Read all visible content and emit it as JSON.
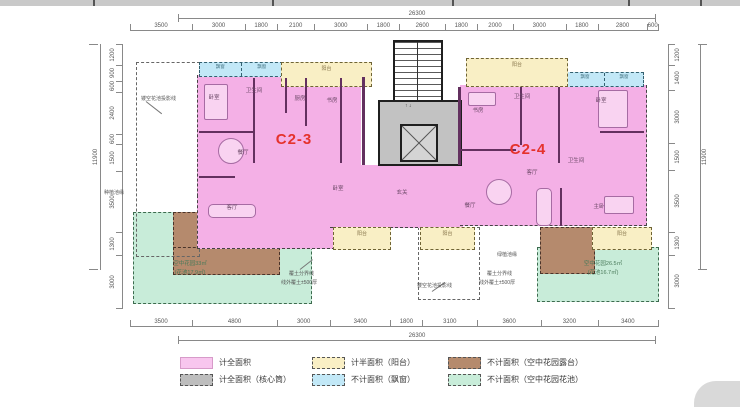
{
  "units": {
    "left": "C2-3",
    "right": "C2-4"
  },
  "dims": {
    "top_total": "26300",
    "top": [
      "3500",
      "3000",
      "1800",
      "2100",
      "3000",
      "1800",
      "2600",
      "1800",
      "2000",
      "3000",
      "1800",
      "2800",
      "600"
    ],
    "bottom": [
      "3500",
      "4800",
      "3000",
      "3400",
      "1800",
      "3100",
      "3600",
      "3200",
      "3400"
    ],
    "bottom_total": "26300",
    "left": [
      "1200",
      "900",
      "600",
      "2400",
      "600",
      "1500",
      "3500",
      "1300",
      "3000"
    ],
    "left_total": "11900",
    "right": [
      "1200",
      "1400",
      "3000",
      "1500",
      "3500",
      "1300",
      "3000"
    ],
    "right_total": "11900"
  },
  "plan": {
    "balcony_label": "阳台",
    "bay_window_label": "飘窗",
    "stair_updown": "↑ ↓",
    "left_garden_area": "空中花园33㎡",
    "left_garden_sub": "(花池17.9㎡)",
    "right_garden_area": "空中花园26.5㎡",
    "right_garden_sub": "(花池16.7㎡)",
    "rooms": [
      {
        "t": "卧室",
        "x": 214,
        "y": 97
      },
      {
        "t": "卫生间",
        "x": 254,
        "y": 90
      },
      {
        "t": "厨房",
        "x": 300,
        "y": 98
      },
      {
        "t": "书房",
        "x": 332,
        "y": 100
      },
      {
        "t": "餐厅",
        "x": 243,
        "y": 152
      },
      {
        "t": "客厅",
        "x": 232,
        "y": 207
      },
      {
        "t": "卧室",
        "x": 338,
        "y": 188
      },
      {
        "t": "玄关",
        "x": 402,
        "y": 192
      },
      {
        "t": "书房",
        "x": 478,
        "y": 110
      },
      {
        "t": "卫生间",
        "x": 522,
        "y": 96
      },
      {
        "t": "餐厅",
        "x": 470,
        "y": 205
      },
      {
        "t": "客厅",
        "x": 532,
        "y": 172
      },
      {
        "t": "卧室",
        "x": 601,
        "y": 100
      },
      {
        "t": "卫生间",
        "x": 576,
        "y": 160
      },
      {
        "t": "主卧",
        "x": 599,
        "y": 206
      }
    ],
    "annotations": [
      {
        "t": "镂空花池投影线",
        "x": 141,
        "y": 95
      },
      {
        "t": "种植池缘",
        "x": 104,
        "y": 189
      },
      {
        "t": "覆土分界线",
        "x": 289,
        "y": 270
      },
      {
        "t": "线外覆土±500厚",
        "x": 281,
        "y": 279
      },
      {
        "t": "镂空花池投影线",
        "x": 417,
        "y": 282
      },
      {
        "t": "绿植池缘",
        "x": 497,
        "y": 251
      },
      {
        "t": "覆土分界线",
        "x": 487,
        "y": 270
      },
      {
        "t": "线外覆土±500厚",
        "x": 479,
        "y": 279
      }
    ]
  },
  "legend": {
    "items": [
      {
        "label": "计全面积",
        "color": "#f8c6ee",
        "dashed": false
      },
      {
        "label": "计半面积（阳台）",
        "color": "#f9efc5",
        "dashed": true
      },
      {
        "label": "不计面积（空中花园露台）",
        "color": "#b58a6d",
        "dashed": true
      },
      {
        "label": "计全面积（核心筒）",
        "color": "#bdbdbd",
        "dashed": true
      },
      {
        "label": "不计面积（飘窗）",
        "color": "#c2e8f7",
        "dashed": true
      },
      {
        "label": "不计面积（空中花园花池）",
        "color": "#c8ecd9",
        "dashed": true
      }
    ]
  },
  "colors": {
    "unit_fill": "#f4b0e6",
    "accent_red": "#e5322c",
    "core_gray": "#c2c2c2"
  }
}
